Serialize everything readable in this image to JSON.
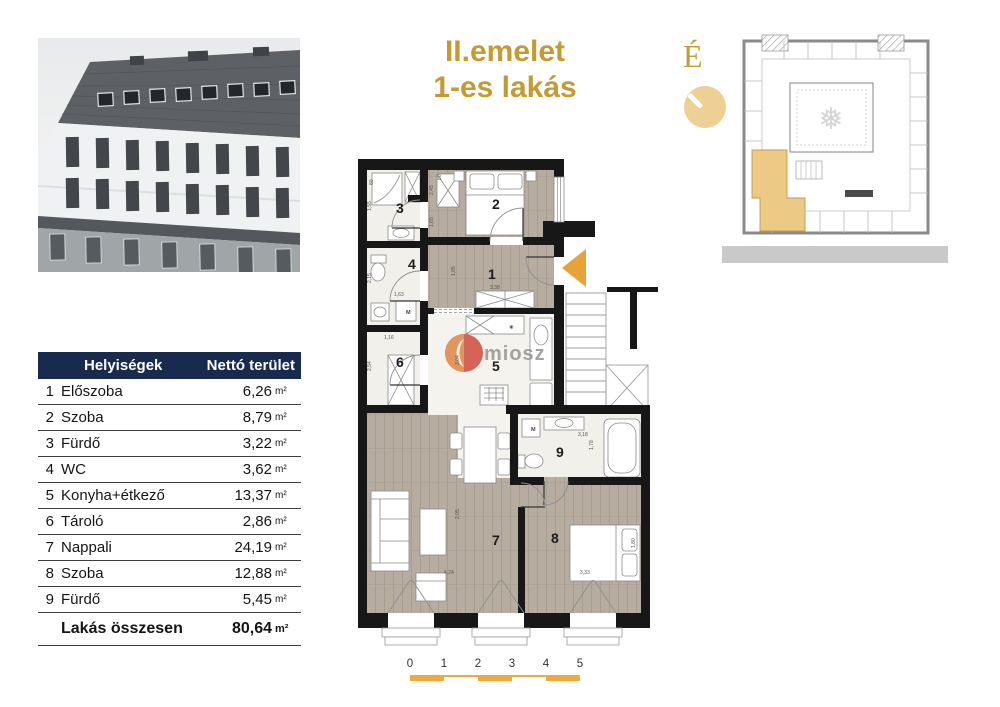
{
  "title": {
    "line1": "II.emelet",
    "line2": "1-es lakás"
  },
  "compass": {
    "label": "É"
  },
  "watermark": {
    "text": "miosz"
  },
  "table": {
    "header": {
      "col1": "Helyiségek",
      "col2": "Nettó terület"
    },
    "rows": [
      {
        "num": "1",
        "name": "Előszoba",
        "value": "6,26",
        "unit": "m²"
      },
      {
        "num": "2",
        "name": "Szoba",
        "value": "8,79",
        "unit": "m²"
      },
      {
        "num": "3",
        "name": "Fürdő",
        "value": "3,22",
        "unit": "m²"
      },
      {
        "num": "4",
        "name": "WC",
        "value": "3,62",
        "unit": "m²"
      },
      {
        "num": "5",
        "name": "Konyha+étkező",
        "value": "13,37",
        "unit": "m²"
      },
      {
        "num": "6",
        "name": "Tároló",
        "value": "2,86",
        "unit": "m²"
      },
      {
        "num": "7",
        "name": "Nappali",
        "value": "24,19",
        "unit": "m²"
      },
      {
        "num": "8",
        "name": "Szoba",
        "value": "12,88",
        "unit": "m²"
      },
      {
        "num": "9",
        "name": "Fürdő",
        "value": "5,45",
        "unit": "m²"
      }
    ],
    "total": {
      "label": "Lakás összesen",
      "value": "80,64",
      "unit": "m²"
    }
  },
  "floorplan": {
    "room_labels": [
      {
        "n": "1",
        "x": 130,
        "y": 136
      },
      {
        "n": "2",
        "x": 134,
        "y": 66
      },
      {
        "n": "3",
        "x": 38,
        "y": 70
      },
      {
        "n": "4",
        "x": 50,
        "y": 126
      },
      {
        "n": "5",
        "x": 134,
        "y": 228
      },
      {
        "n": "6",
        "x": 38,
        "y": 224
      },
      {
        "n": "7",
        "x": 134,
        "y": 402
      },
      {
        "n": "8",
        "x": 193,
        "y": 400
      },
      {
        "n": "9",
        "x": 198,
        "y": 314
      }
    ],
    "dimensions": [
      {
        "t": "80",
        "x": 15,
        "y": 42,
        "r": -90
      },
      {
        "t": "1,55",
        "x": 13,
        "y": 68,
        "r": -90
      },
      {
        "t": "2,45",
        "x": 75,
        "y": 52,
        "r": -90
      },
      {
        "t": "80",
        "x": 83,
        "y": 37,
        "r": -90
      },
      {
        "t": "1,65",
        "x": 75,
        "y": 84,
        "r": -90
      },
      {
        "t": "2,15",
        "x": 13,
        "y": 140,
        "r": -90
      },
      {
        "t": "1,63",
        "x": 36,
        "y": 153,
        "r": 0
      },
      {
        "t": "1,16",
        "x": 26,
        "y": 196,
        "r": 0
      },
      {
        "t": "2,54",
        "x": 13,
        "y": 228,
        "r": -90
      },
      {
        "t": "1,85",
        "x": 97,
        "y": 133,
        "r": -90
      },
      {
        "t": "3,38",
        "x": 132,
        "y": 146,
        "r": 0
      },
      {
        "t": "3,04",
        "x": 101,
        "y": 222,
        "r": -90
      },
      {
        "t": "3,18",
        "x": 220,
        "y": 293,
        "r": 0
      },
      {
        "t": "1,78",
        "x": 235,
        "y": 307,
        "r": -90
      },
      {
        "t": "2,05",
        "x": 101,
        "y": 376,
        "r": -90
      },
      {
        "t": "4,24",
        "x": 86,
        "y": 431,
        "r": 0
      },
      {
        "t": "3,33",
        "x": 222,
        "y": 431,
        "r": 0
      },
      {
        "t": "1,80",
        "x": 277,
        "y": 405,
        "r": -90
      }
    ],
    "appliance_labels": [
      {
        "t": "M",
        "x": 48,
        "y": 171
      },
      {
        "t": "M",
        "x": 173,
        "y": 288
      }
    ],
    "hob_icon": {
      "t": "✳",
      "x": 151,
      "y": 186
    }
  },
  "overview": {
    "ornament": "❅"
  },
  "scalebar": {
    "ticks": [
      "0",
      "1",
      "2",
      "3",
      "4",
      "5"
    ]
  },
  "colors": {
    "gold_title": "#c49a33",
    "gold_arrow": "#e7a33a",
    "gold_light": "#eed095",
    "navy_header": "#182b4f",
    "wall": "#171717",
    "wood_floor": "#b6ac9f",
    "tile_floor": "#f2f0ea",
    "overview_highlight": "#ecca86",
    "scale_gold": "#efa93d"
  }
}
